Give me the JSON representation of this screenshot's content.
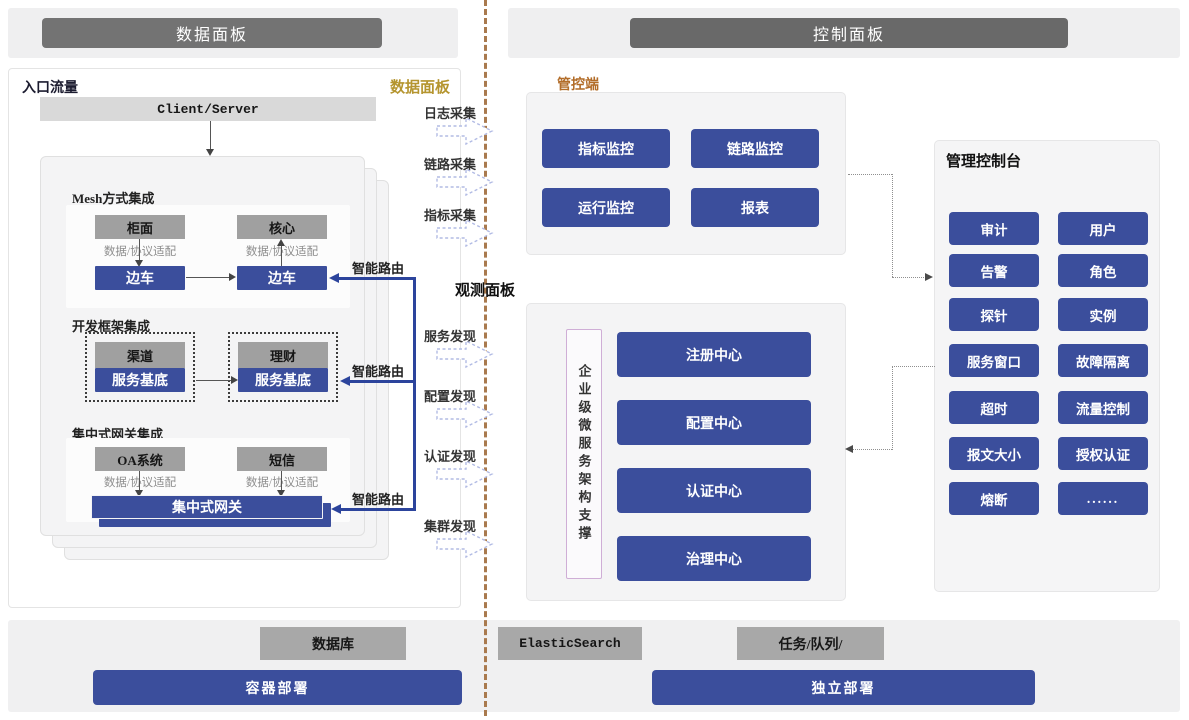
{
  "headers": {
    "left": "数据面板",
    "right": "控制面板"
  },
  "data_plane": {
    "corner_label": "数据面板",
    "entry_label": "入口流量",
    "client_server": "Client/Server",
    "adapter_label": "数据/协议适配",
    "smart_route": "智能路由",
    "mesh": {
      "title": "Mesh方式集成",
      "box1": "柜面",
      "box2": "核心",
      "sidecar": "边车"
    },
    "framework": {
      "title": "开发框架集成",
      "left_app": "渠道",
      "right_app": "理财",
      "base": "服务基底"
    },
    "gateway": {
      "title": "集中式网关集成",
      "box1": "OA系统",
      "box2": "短信",
      "bar": "集中式网关"
    }
  },
  "flows": {
    "collect": [
      {
        "label": "日志采集"
      },
      {
        "label": "链路采集"
      },
      {
        "label": "指标采集"
      }
    ],
    "observe_label": "观测面板",
    "discover": [
      {
        "label": "服务发现"
      },
      {
        "label": "配置发现"
      },
      {
        "label": "认证发现"
      },
      {
        "label": "集群发现"
      }
    ]
  },
  "control_plane": {
    "mgmt_label": "管控端",
    "monitor_buttons": [
      "指标监控",
      "链路监控",
      "运行监控",
      "报表"
    ],
    "support_vertical": "企业级微服务架构支撑",
    "centers": [
      "注册中心",
      "配置中心",
      "认证中心",
      "治理中心"
    ],
    "console": {
      "title": "管理控制台",
      "buttons": [
        "审计",
        "用户",
        "告警",
        "角色",
        "探针",
        "实例",
        "服务窗口",
        "故障隔离",
        "超时",
        "流量控制",
        "报文大小",
        "授权认证",
        "熔断",
        "......"
      ]
    }
  },
  "infra": {
    "database": "数据库",
    "elastic": "ElasticSearch",
    "queue": "任务/队列/",
    "deploy_left": "容器部署",
    "deploy_right": "独立部署"
  },
  "colors": {
    "accent_blue": "#3b4e9c",
    "route_blue": "#2c449c",
    "gray_box": "#a0a0a0",
    "header_gray": "#737373",
    "gold": "#b5952f",
    "orange": "#b26c28",
    "divider_brown": "#a97a4e"
  }
}
